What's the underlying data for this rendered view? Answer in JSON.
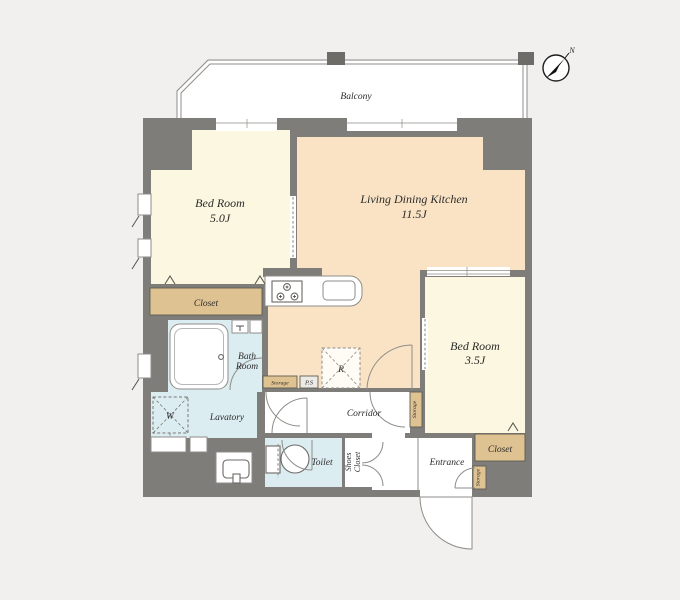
{
  "plan": {
    "compass_label": "N",
    "balcony": "Balcony",
    "bedroom1": {
      "name": "Bed Room",
      "area": "5.0J"
    },
    "ldk": {
      "name": "Living Dining Kitchen",
      "area": "11.5J"
    },
    "bedroom2": {
      "name": "Bed Room",
      "area": "3.5J"
    },
    "closet1": "Closet",
    "closet2": "Closet",
    "bath_line1": "Bath",
    "bath_line2": "Room",
    "lavatory": "Lavatory",
    "toilet": "Toilet",
    "corridor": "Corridor",
    "entrance": "Entrance",
    "shoes_line1": "Shoes",
    "shoes_line2": "Closet",
    "storage_hall": "Storage",
    "storage_bedroom2": "Storage",
    "storage_entrance": "Storage",
    "ps": "P.S",
    "washer": "W",
    "fridge": "R"
  },
  "colors": {
    "bg": "#f1f0ee",
    "wall": "#7f7d7a",
    "wall-dark": "#6e6c69",
    "room-cream": "#fbf7e0",
    "room-peach": "#fae3c4",
    "closet-tan": "#dfc291",
    "room-blue": "#dcedf2",
    "line": "#8f8d89",
    "text": "#2b2b2b"
  }
}
